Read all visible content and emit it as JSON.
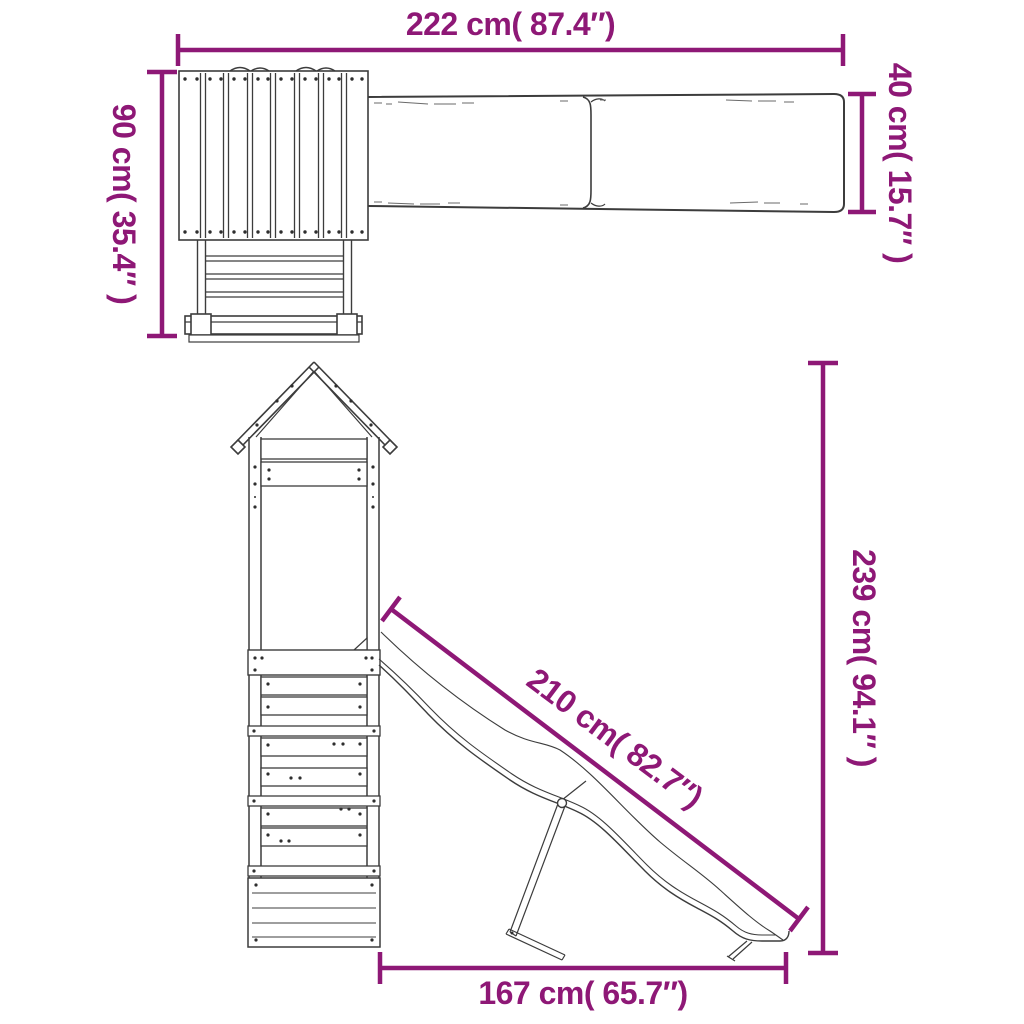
{
  "diagram": {
    "title": "playset dimension drawing",
    "subject": "wooden playhouse tower with ladder and wave slide",
    "style": {
      "background_color": "#FFFFFF",
      "line_color": "#3C3C3C",
      "grain_color": "#6A6A6A",
      "dimension_color": "#8E1876"
    },
    "views": {
      "top_view": {
        "name": "top view",
        "components": [
          "roof-planks",
          "ladder",
          "slide-board"
        ]
      },
      "side_view": {
        "name": "side view",
        "components": [
          "gable-roof",
          "tower-posts",
          "slat-panels",
          "wave-slide",
          "slide-support-leg"
        ]
      }
    },
    "dimensions": {
      "top_width": {
        "value_cm": 222,
        "value_in": 87.4,
        "label": "222 cm( 87.4″)",
        "orientation": "horizontal",
        "applies_to": "overall length (top view)"
      },
      "left_depth": {
        "value_cm": 90,
        "value_in": 35.4,
        "label": "90 cm( 35.4″ )",
        "orientation": "vertical",
        "applies_to": "playhouse depth with ladder (top view)"
      },
      "slide_width": {
        "value_cm": 40,
        "value_in": 15.7,
        "label": "40 cm( 15.7″ )",
        "orientation": "vertical",
        "applies_to": "slide width (top view)"
      },
      "slide_length": {
        "value_cm": 210,
        "value_in": 82.7,
        "label": "210 cm( 82.7″)",
        "orientation": "diagonal",
        "applies_to": "slide length (side view)"
      },
      "total_height": {
        "value_cm": 239,
        "value_in": 94.1,
        "label": "239 cm( 94.1″ )",
        "orientation": "vertical",
        "applies_to": "overall height (side view)"
      },
      "base_depth": {
        "value_cm": 167,
        "value_in": 65.7,
        "label": "167 cm( 65.7″)",
        "orientation": "horizontal",
        "applies_to": "footprint tower to slide end (side view)"
      }
    }
  }
}
